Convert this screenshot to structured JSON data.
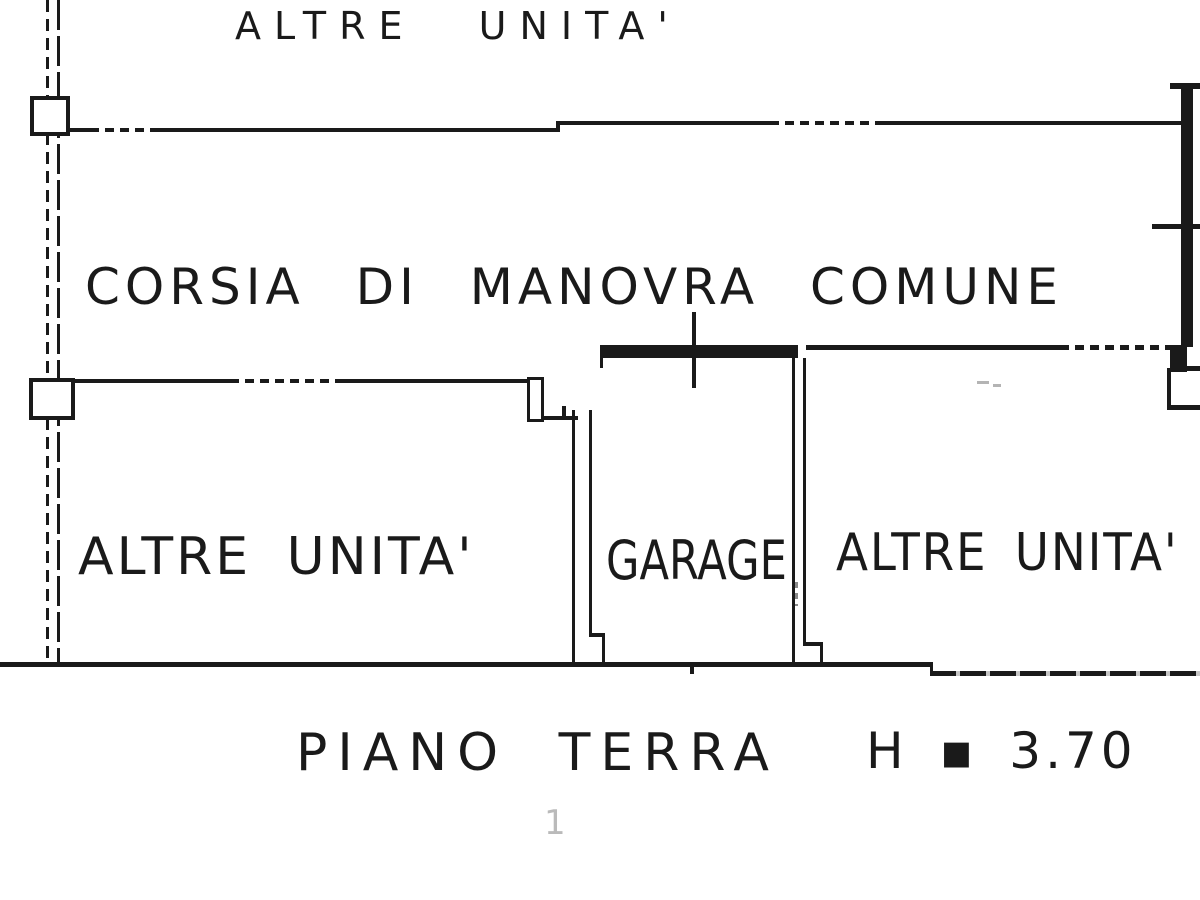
{
  "type": "cadastral-floor-plan",
  "floor_plan": {
    "labels": {
      "top_unit": "ALTRE UNITA'",
      "corridor": "CORSIA DI MANOVRA COMUNE",
      "left_unit": "ALTRE UNITA'",
      "garage": "GARAGE",
      "right_unit": "ALTRE UNITA'",
      "floor_level": "PIANO TERRA",
      "ceiling_height": "H ▪ 3.70",
      "page_mark": "1"
    },
    "colors": {
      "ink": "#1a1a1a",
      "paper": "#ffffff",
      "faint_gray": "#9b9b9b"
    }
  }
}
